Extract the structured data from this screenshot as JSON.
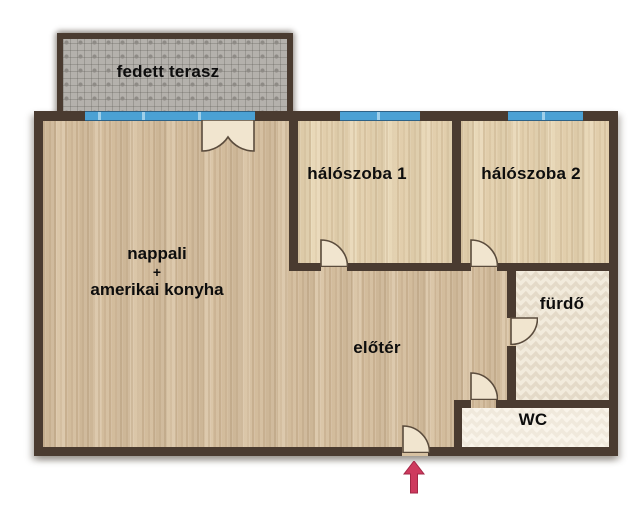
{
  "plan": {
    "title": "apartment floor plan",
    "rooms": {
      "terrace": {
        "label": "fedett terasz"
      },
      "bedroom1": {
        "label": "hálószoba 1"
      },
      "bedroom2": {
        "label": "hálószoba 2"
      },
      "living": {
        "line1": "nappali",
        "line2": "+",
        "line3": "amerikai konyha"
      },
      "hall": {
        "label": "előtér"
      },
      "bathroom": {
        "label": "fürdő"
      },
      "wc": {
        "label": "WC"
      }
    },
    "entrance_arrow": {
      "direction": "up",
      "color": "#ce3a5e"
    },
    "palette": {
      "wall": "#4a3b30",
      "window_blue": "#4ba1d4",
      "living_floor": "#d7c1a1",
      "bedroom_floor": "#e6d4b1",
      "terrace_tile": "#b4b1ac",
      "bath_tile": "#e4dac8",
      "wc_tile": "#f0e9dc",
      "door_leaf": "#f1e5cf"
    }
  }
}
